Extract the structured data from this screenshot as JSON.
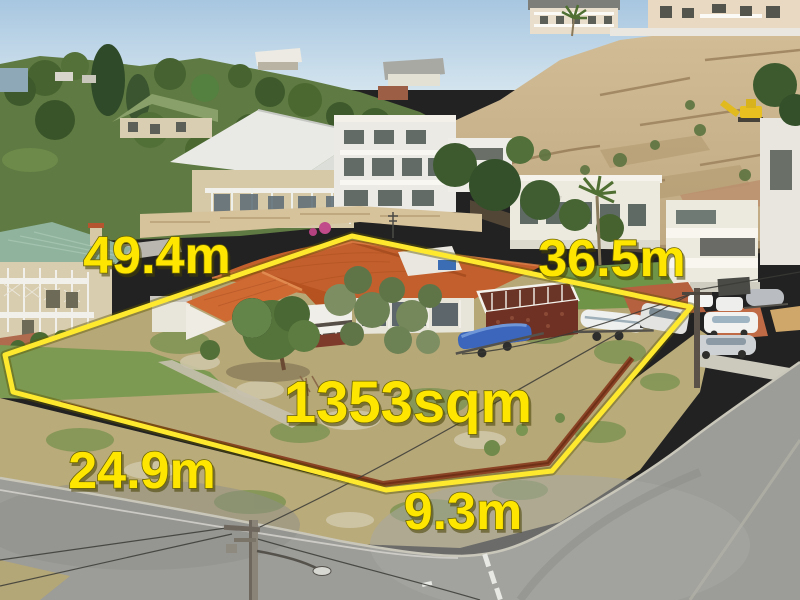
{
  "scene": {
    "kind": "aerial real-estate photograph with site boundary overlay",
    "labels": {
      "side_left": "49.4m",
      "side_right": "36.5m",
      "side_bottom_left": "24.9m",
      "side_bottom": "9.3m",
      "area": "1353sqm"
    },
    "colors": {
      "boundary_line": "#ffe92e",
      "label_text": "#ffe600",
      "label_shadow": "#6b6400",
      "roof_terracotta": "#c35f2c",
      "retaining_wall_rust": "#8a4425",
      "sky_top": "#a7c6e0",
      "road_asphalt": "#9c9c98",
      "dry_grass": "#b7a878",
      "lawn_green": "#7d9a52",
      "limestone_cliff": "#c9b48f"
    }
  }
}
